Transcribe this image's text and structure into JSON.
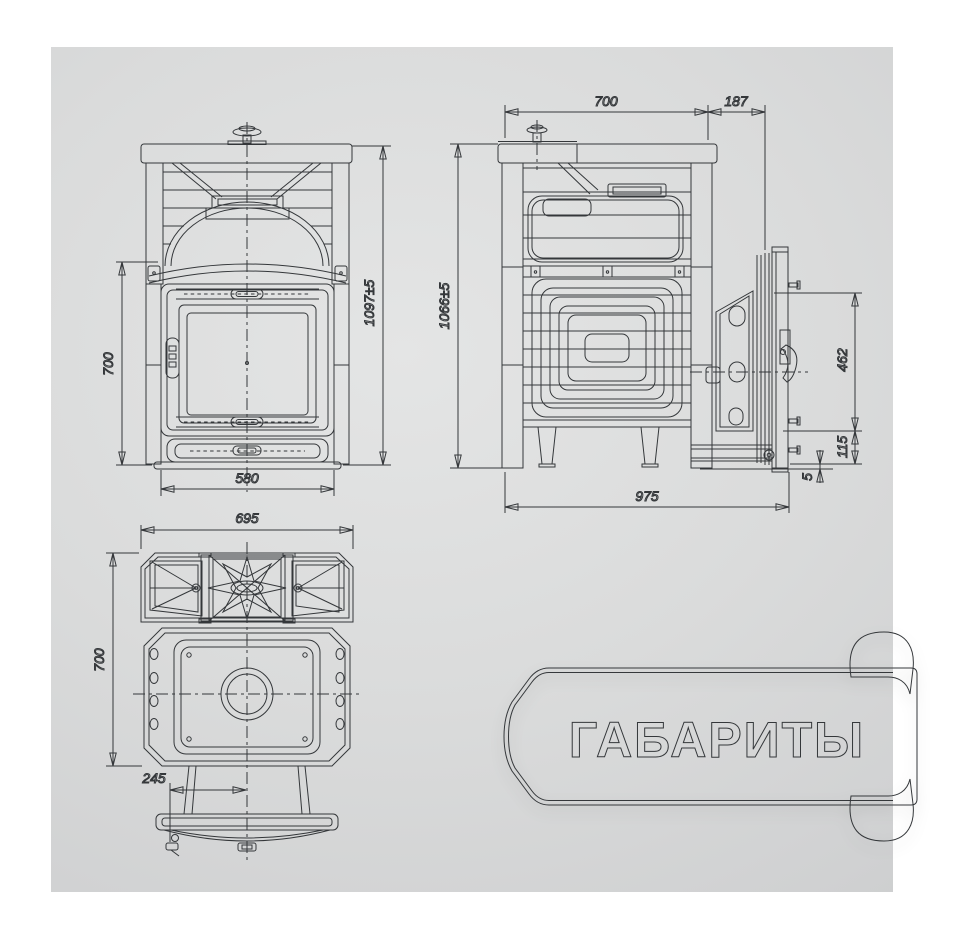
{
  "banner": {
    "label": "ГАБАРИТЫ"
  },
  "dimensions": {
    "front": {
      "door_height": "700",
      "total_height": "1097±5",
      "width": "580"
    },
    "side": {
      "body_depth": "700",
      "door_depth": "187",
      "total_height": "1066±5",
      "door_height": "462",
      "door_bottom": "115",
      "floor_gap": "5",
      "total_depth": "975"
    },
    "top": {
      "width": "695",
      "depth": "700",
      "tunnel_offset": "245"
    }
  },
  "colors": {
    "ribbon_teal": "#2d7187",
    "ribbon_fold_dark": "#123e4e",
    "banner_text": "#2d2f30",
    "backdrop": "#d6d7d8",
    "line": "#34373a"
  }
}
